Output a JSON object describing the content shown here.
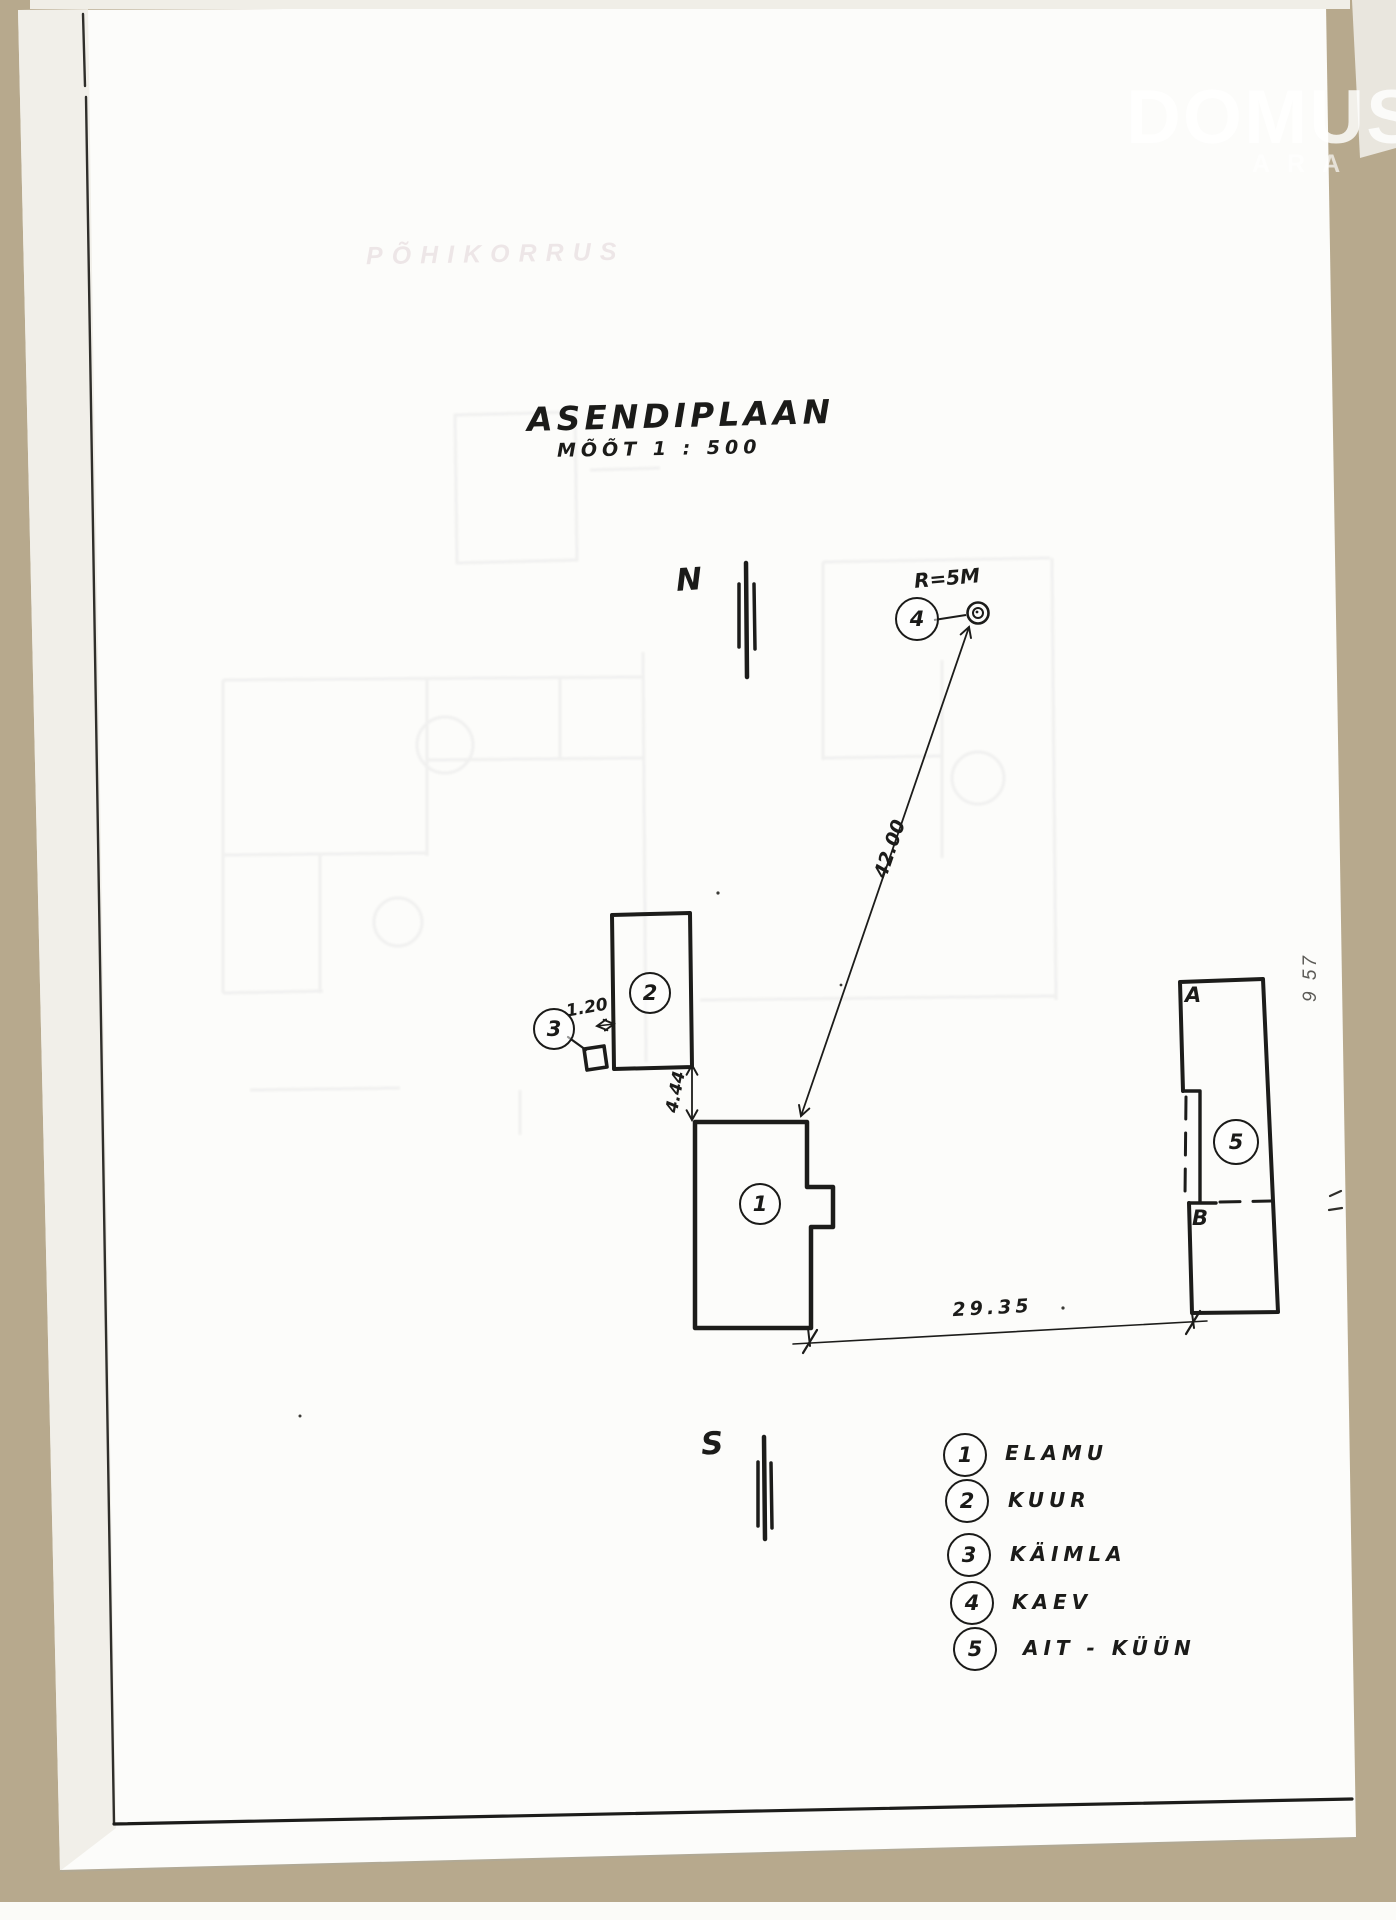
{
  "document": {
    "title": "ASENDIPLAAN",
    "scale_label": "MÕÕT 1 : 500"
  },
  "compass": {
    "north_label": "N",
    "south_label": "S"
  },
  "watermark": {
    "line1": "DOMUS",
    "line2": "ARA"
  },
  "ghost_bleedthrough_text": "PÕHIKORRUS",
  "margin_note": "9 57",
  "plan": {
    "markers": [
      {
        "num": "1"
      },
      {
        "num": "2"
      },
      {
        "num": "3"
      },
      {
        "num": "4"
      },
      {
        "num": "5"
      }
    ],
    "corner_labels": {
      "a": "A",
      "b": "B"
    },
    "dimensions": {
      "well_note": "R=5M",
      "diagonal_to_well": "42.00",
      "bottom_span": "29.35",
      "house_shed_gap": "4.44",
      "outhouse_gap": "1.20"
    }
  },
  "legend": {
    "items": [
      {
        "num": "1",
        "label": "ELAMU"
      },
      {
        "num": "2",
        "label": "KUUR"
      },
      {
        "num": "3",
        "label": "KÄIMLA"
      },
      {
        "num": "4",
        "label": "KAEV"
      },
      {
        "num": "5",
        "label": "AIT - KÜÜN"
      }
    ]
  }
}
